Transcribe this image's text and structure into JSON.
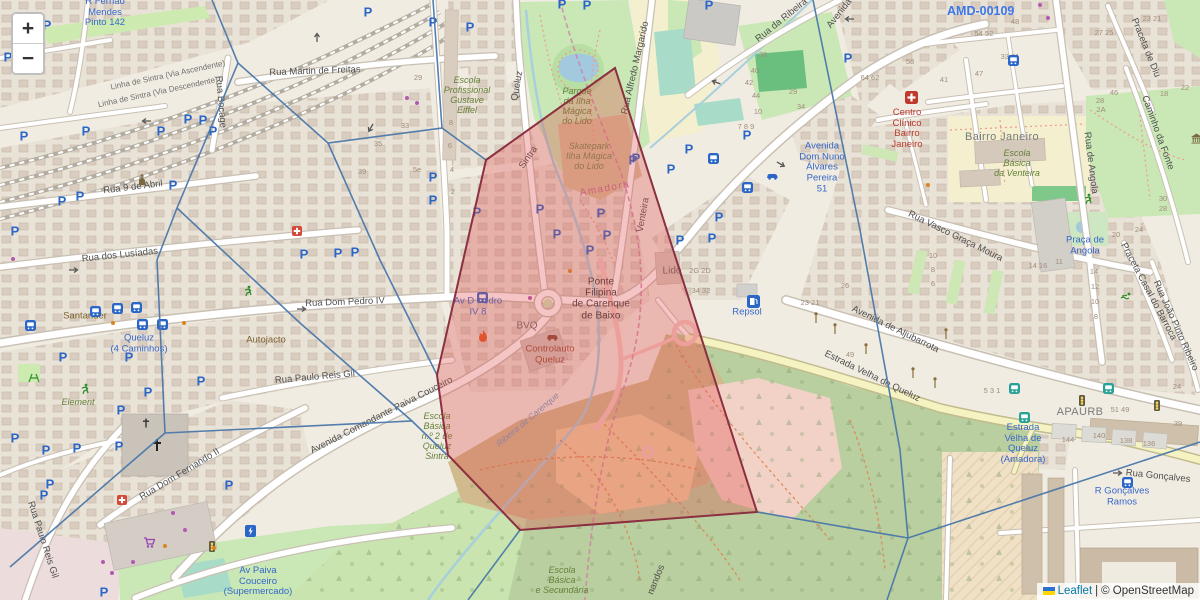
{
  "controls": {
    "zoom_in": "+",
    "zoom_out": "−"
  },
  "attribution": {
    "leaflet": "Leaflet",
    "sep": "|",
    "osm": "© OpenStreetMap"
  },
  "marker": {
    "ref": "AMD-00109"
  },
  "colors": {
    "overlay_fill": "#e04c4c",
    "overlay_stroke": "#8b3040",
    "voronoi_stroke": "#4a78aa",
    "parking_blue": "#2a66c8",
    "transit_blue": "#3667c9"
  },
  "labels": [
    {
      "t": "Rua Martin de Freitas",
      "x": 315,
      "y": 72,
      "c": "road",
      "r": -2
    },
    {
      "t": "Rua 9 de Abril",
      "x": 133,
      "y": 188,
      "c": "road",
      "r": -7
    },
    {
      "t": "Rua dos Lusíadas",
      "x": 120,
      "y": 256,
      "c": "road",
      "r": -6
    },
    {
      "t": "Rua Dom Pedro IV",
      "x": 345,
      "y": 303,
      "c": "road",
      "r": -2
    },
    {
      "t": "Rua Bocage",
      "x": 220,
      "y": 102,
      "c": "road",
      "r": 85
    },
    {
      "t": "Rua Paulo Reis Gil",
      "x": 315,
      "y": 378,
      "c": "road",
      "r": -5
    },
    {
      "t": "Rua Paulo Reis Gil",
      "x": 42,
      "y": 540,
      "c": "road",
      "r": 72
    },
    {
      "t": "Avenida Comandante Paiva Couceiro",
      "x": 382,
      "y": 416,
      "c": "road",
      "r": -27
    },
    {
      "t": "Rua Dom Fernando II",
      "x": 180,
      "y": 475,
      "c": "road",
      "r": -31
    },
    {
      "t": "Av Paiva\nCouceiro\n(Supermercado)",
      "x": 258,
      "y": 582,
      "c": "transit"
    },
    {
      "t": "Element",
      "x": 78,
      "y": 402,
      "c": "school"
    },
    {
      "t": "Santander",
      "x": 85,
      "y": 317,
      "c": "poi"
    },
    {
      "t": "Queluz\n(4 Caminhos)",
      "x": 139,
      "y": 344,
      "c": "transit"
    },
    {
      "t": "Autojacto",
      "x": 266,
      "y": 341,
      "c": "poi"
    },
    {
      "t": "Rua Alfredo Margarido",
      "x": 636,
      "y": 68,
      "c": "road",
      "r": -77
    },
    {
      "t": "Queluz",
      "x": 518,
      "y": 86,
      "c": "road",
      "r": -80
    },
    {
      "t": "Sintra",
      "x": 529,
      "y": 158,
      "c": "road",
      "r": -55
    },
    {
      "t": "Amadora",
      "x": 605,
      "y": 189,
      "c": "bound",
      "r": -10
    },
    {
      "t": "Venteira",
      "x": 644,
      "y": 215,
      "c": "road",
      "r": -80
    },
    {
      "t": "Lido",
      "x": 672,
      "y": 271,
      "c": "gray"
    },
    {
      "t": "Ponte\nFilipina\nde Carenque\nde Baixo",
      "x": 601,
      "y": 299,
      "c": "dark"
    },
    {
      "t": "Av D Pedro\nIV 8",
      "x": 478,
      "y": 307,
      "c": "transit"
    },
    {
      "t": "BVQ",
      "x": 527,
      "y": 326,
      "c": "gray"
    },
    {
      "t": "Controlauto\nQueluz",
      "x": 550,
      "y": 355,
      "c": "shopred"
    },
    {
      "t": "Repsol",
      "x": 747,
      "y": 313,
      "c": "transit"
    },
    {
      "t": "Avenida de Aljubarrota",
      "x": 895,
      "y": 330,
      "c": "road",
      "r": 26
    },
    {
      "t": "Estrada Velha de Queluz",
      "x": 872,
      "y": 377,
      "c": "road",
      "r": 26
    },
    {
      "t": "Rua Vasco Graça Moura",
      "x": 955,
      "y": 237,
      "c": "road",
      "r": 26
    },
    {
      "t": "Bairro Janeiro",
      "x": 1002,
      "y": 137,
      "c": "place"
    },
    {
      "t": "Escola\nBásica\nda Venteira",
      "x": 1017,
      "y": 163,
      "c": "school"
    },
    {
      "t": "Centro\nClínico\nBairro\nJaneiro",
      "x": 907,
      "y": 129,
      "c": "health"
    },
    {
      "t": "Avenida\nDom Nuno\nÁlvares\nPereira\n51",
      "x": 822,
      "y": 168,
      "c": "transit"
    },
    {
      "t": "Praceta de Diu",
      "x": 1145,
      "y": 48,
      "c": "road",
      "r": 68
    },
    {
      "t": "Caminho da Fonte",
      "x": 1157,
      "y": 133,
      "c": "road",
      "r": 70
    },
    {
      "t": "Rua de Angola",
      "x": 1090,
      "y": 163,
      "c": "road",
      "r": 83
    },
    {
      "t": "Praça de\nAngola",
      "x": 1085,
      "y": 246,
      "c": "transit"
    },
    {
      "t": "Praceta Casal do Barroca",
      "x": 1148,
      "y": 292,
      "c": "road",
      "r": 62
    },
    {
      "t": "Rua João Pinto Ribeiro",
      "x": 1175,
      "y": 326,
      "c": "road",
      "r": 66
    },
    {
      "t": "APAURB",
      "x": 1080,
      "y": 412,
      "c": "place"
    },
    {
      "t": "Estrada\nVelha de\nQueluz\n(Amadora)",
      "x": 1023,
      "y": 444,
      "c": "transit"
    },
    {
      "t": "Rua Gonçalves",
      "x": 1158,
      "y": 477,
      "c": "road",
      "r": 6
    },
    {
      "t": "R Gonçalves\nRamos",
      "x": 1122,
      "y": 497,
      "c": "transit"
    },
    {
      "t": "Escola\nBásica\ne Secundária",
      "x": 562,
      "y": 580,
      "c": "school"
    },
    {
      "t": "Escola\nBásica\nn.º 2 de\nQueluz\nSintra",
      "x": 437,
      "y": 436,
      "c": "school"
    },
    {
      "t": "Escola\nProfissional\nGustave\nEiffel",
      "x": 467,
      "y": 95,
      "c": "school"
    },
    {
      "t": "Parque\nda Ilha\nMágica\ndo Lido",
      "x": 577,
      "y": 106,
      "c": "school"
    },
    {
      "t": "Skatepark\nIlha Mágica\ndo Lido",
      "x": 589,
      "y": 156,
      "c": "leisure"
    },
    {
      "t": "R Fernão\nMendes\nPinto 142",
      "x": 105,
      "y": 13,
      "c": "transit"
    },
    {
      "t": "Linha de Sintra (Via Ascendente)",
      "x": 168,
      "y": 76,
      "c": "rail",
      "r": -12
    },
    {
      "t": "Linha de Sintra (Via Descendente)",
      "x": 158,
      "y": 93,
      "c": "rail",
      "r": -12
    },
    {
      "t": "Rua da Ribeira",
      "x": 782,
      "y": 21,
      "c": "road",
      "r": -39
    },
    {
      "t": "Avenida",
      "x": 840,
      "y": 14,
      "c": "road",
      "r": -52
    },
    {
      "t": "Ribeira de Carenque",
      "x": 528,
      "y": 420,
      "c": "water",
      "r": -40
    },
    {
      "t": "nandos",
      "x": 657,
      "y": 580,
      "c": "road",
      "r": -68
    },
    {
      "t": "29",
      "x": 418,
      "y": 78,
      "c": "num"
    },
    {
      "t": "33",
      "x": 405,
      "y": 126,
      "c": "num"
    },
    {
      "t": "8",
      "x": 451,
      "y": 123,
      "c": "num"
    },
    {
      "t": "6",
      "x": 450,
      "y": 146,
      "c": "num"
    },
    {
      "t": "4",
      "x": 452,
      "y": 170,
      "c": "num"
    },
    {
      "t": "2",
      "x": 453,
      "y": 192,
      "c": "num"
    },
    {
      "t": "5e",
      "x": 417,
      "y": 170,
      "c": "num"
    },
    {
      "t": "35",
      "x": 378,
      "y": 144,
      "c": "num"
    },
    {
      "t": "39",
      "x": 362,
      "y": 172,
      "c": "num"
    },
    {
      "t": "38",
      "x": 763,
      "y": 55,
      "c": "num"
    },
    {
      "t": "40",
      "x": 755,
      "y": 71,
      "c": "num"
    },
    {
      "t": "42",
      "x": 749,
      "y": 83,
      "c": "num"
    },
    {
      "t": "44",
      "x": 756,
      "y": 96,
      "c": "num"
    },
    {
      "t": "10",
      "x": 758,
      "y": 112,
      "c": "num"
    },
    {
      "t": "29",
      "x": 793,
      "y": 92,
      "c": "num"
    },
    {
      "t": "34",
      "x": 801,
      "y": 107,
      "c": "num"
    },
    {
      "t": "7 8 9",
      "x": 746,
      "y": 127,
      "c": "num"
    },
    {
      "t": "2G 2D",
      "x": 700,
      "y": 271,
      "c": "num"
    },
    {
      "t": "34 32",
      "x": 701,
      "y": 291,
      "c": "num"
    },
    {
      "t": "23 21",
      "x": 810,
      "y": 303,
      "c": "num"
    },
    {
      "t": "26",
      "x": 845,
      "y": 286,
      "c": "num"
    },
    {
      "t": "49",
      "x": 850,
      "y": 355,
      "c": "num"
    },
    {
      "t": "64 62",
      "x": 870,
      "y": 78,
      "c": "num"
    },
    {
      "t": "58",
      "x": 910,
      "y": 62,
      "c": "num"
    },
    {
      "t": "41",
      "x": 944,
      "y": 80,
      "c": "num"
    },
    {
      "t": "47",
      "x": 979,
      "y": 74,
      "c": "num"
    },
    {
      "t": "48",
      "x": 1015,
      "y": 22,
      "c": "num"
    },
    {
      "t": "54 52",
      "x": 984,
      "y": 34,
      "c": "num"
    },
    {
      "t": "33 31",
      "x": 1010,
      "y": 57,
      "c": "num"
    },
    {
      "t": "27 25",
      "x": 1104,
      "y": 33,
      "c": "num"
    },
    {
      "t": "46",
      "x": 1114,
      "y": 93,
      "c": "num"
    },
    {
      "t": "28",
      "x": 1100,
      "y": 101,
      "c": "num"
    },
    {
      "t": "2A",
      "x": 1101,
      "y": 110,
      "c": "num"
    },
    {
      "t": "23 21",
      "x": 1152,
      "y": 19,
      "c": "num"
    },
    {
      "t": "18",
      "x": 1164,
      "y": 94,
      "c": "num"
    },
    {
      "t": "22",
      "x": 1185,
      "y": 88,
      "c": "num"
    },
    {
      "t": "14 16",
      "x": 1038,
      "y": 266,
      "c": "num"
    },
    {
      "t": "11",
      "x": 1059,
      "y": 262,
      "c": "num"
    },
    {
      "t": "20",
      "x": 1116,
      "y": 235,
      "c": "num"
    },
    {
      "t": "24",
      "x": 1139,
      "y": 230,
      "c": "num"
    },
    {
      "t": "28",
      "x": 1163,
      "y": 209,
      "c": "num"
    },
    {
      "t": "30",
      "x": 1163,
      "y": 199,
      "c": "num"
    },
    {
      "t": "14",
      "x": 1094,
      "y": 272,
      "c": "num"
    },
    {
      "t": "12",
      "x": 1095,
      "y": 287,
      "c": "num"
    },
    {
      "t": "10",
      "x": 1095,
      "y": 302,
      "c": "num"
    },
    {
      "t": "8",
      "x": 1096,
      "y": 317,
      "c": "num"
    },
    {
      "t": "10",
      "x": 933,
      "y": 256,
      "c": "num"
    },
    {
      "t": "8",
      "x": 933,
      "y": 270,
      "c": "num"
    },
    {
      "t": "6",
      "x": 933,
      "y": 284,
      "c": "num"
    },
    {
      "t": "144",
      "x": 1068,
      "y": 440,
      "c": "num"
    },
    {
      "t": "140",
      "x": 1099,
      "y": 436,
      "c": "num"
    },
    {
      "t": "138",
      "x": 1126,
      "y": 441,
      "c": "num"
    },
    {
      "t": "136",
      "x": 1149,
      "y": 444,
      "c": "num"
    },
    {
      "t": "51 49",
      "x": 1120,
      "y": 410,
      "c": "num"
    },
    {
      "t": "39",
      "x": 1178,
      "y": 424,
      "c": "num"
    },
    {
      "t": "5 3 1",
      "x": 992,
      "y": 391,
      "c": "num"
    },
    {
      "t": "24",
      "x": 1177,
      "y": 387,
      "c": "num"
    }
  ],
  "icons": [
    {
      "k": "p",
      "x": 47,
      "y": 25
    },
    {
      "k": "p",
      "x": 8,
      "y": 57
    },
    {
      "k": "p",
      "x": 188,
      "y": 119
    },
    {
      "k": "p",
      "x": 203,
      "y": 120
    },
    {
      "k": "p",
      "x": 161,
      "y": 131
    },
    {
      "k": "p",
      "x": 86,
      "y": 131
    },
    {
      "k": "p",
      "x": 24,
      "y": 136
    },
    {
      "k": "p",
      "x": 62,
      "y": 201
    },
    {
      "k": "p",
      "x": 80,
      "y": 196
    },
    {
      "k": "p",
      "x": 173,
      "y": 185
    },
    {
      "k": "p",
      "x": 15,
      "y": 231
    },
    {
      "k": "p",
      "x": 63,
      "y": 357
    },
    {
      "k": "p",
      "x": 129,
      "y": 357
    },
    {
      "k": "p",
      "x": 148,
      "y": 392
    },
    {
      "k": "p",
      "x": 201,
      "y": 381
    },
    {
      "k": "p",
      "x": 121,
      "y": 410
    },
    {
      "k": "p",
      "x": 119,
      "y": 446
    },
    {
      "k": "p",
      "x": 46,
      "y": 450
    },
    {
      "k": "p",
      "x": 15,
      "y": 438
    },
    {
      "k": "p",
      "x": 77,
      "y": 448
    },
    {
      "k": "p",
      "x": 50,
      "y": 484
    },
    {
      "k": "p",
      "x": 44,
      "y": 495
    },
    {
      "k": "p",
      "x": 229,
      "y": 485
    },
    {
      "k": "p",
      "x": 104,
      "y": 592
    },
    {
      "k": "p",
      "x": 213,
      "y": 131
    },
    {
      "k": "p",
      "x": 368,
      "y": 12
    },
    {
      "k": "p",
      "x": 433,
      "y": 22
    },
    {
      "k": "p",
      "x": 433,
      "y": 177
    },
    {
      "k": "p",
      "x": 433,
      "y": 200
    },
    {
      "k": "p",
      "x": 304,
      "y": 254
    },
    {
      "k": "p",
      "x": 338,
      "y": 253
    },
    {
      "k": "p",
      "x": 355,
      "y": 252
    },
    {
      "k": "p",
      "x": 470,
      "y": 27
    },
    {
      "k": "p",
      "x": 562,
      "y": 4
    },
    {
      "k": "p",
      "x": 587,
      "y": 5
    },
    {
      "k": "p",
      "x": 477,
      "y": 212
    },
    {
      "k": "p",
      "x": 540,
      "y": 209
    },
    {
      "k": "p",
      "x": 601,
      "y": 213
    },
    {
      "k": "p",
      "x": 633,
      "y": 160
    },
    {
      "k": "p",
      "x": 557,
      "y": 234
    },
    {
      "k": "p",
      "x": 590,
      "y": 250
    },
    {
      "k": "p",
      "x": 607,
      "y": 235
    },
    {
      "k": "p",
      "x": 747,
      "y": 135
    },
    {
      "k": "p",
      "x": 689,
      "y": 149
    },
    {
      "k": "p",
      "x": 671,
      "y": 169
    },
    {
      "k": "p",
      "x": 719,
      "y": 217
    },
    {
      "k": "p",
      "x": 712,
      "y": 238
    },
    {
      "k": "p",
      "x": 680,
      "y": 240
    },
    {
      "k": "p",
      "x": 636,
      "y": 158
    },
    {
      "k": "p",
      "x": 848,
      "y": 58
    },
    {
      "k": "p",
      "x": 709,
      "y": 5
    },
    {
      "k": "bus",
      "x": 90,
      "y": 306
    },
    {
      "k": "bus",
      "x": 112,
      "y": 303
    },
    {
      "k": "bus",
      "x": 131,
      "y": 302
    },
    {
      "k": "bus",
      "x": 137,
      "y": 319
    },
    {
      "k": "bus",
      "x": 157,
      "y": 319
    },
    {
      "k": "bus",
      "x": 25,
      "y": 320
    },
    {
      "k": "bus",
      "x": 477,
      "y": 292
    },
    {
      "k": "bus",
      "x": 708,
      "y": 153
    },
    {
      "k": "bus",
      "x": 742,
      "y": 182
    },
    {
      "k": "bus",
      "x": 1122,
      "y": 477
    },
    {
      "k": "bus",
      "x": 1008,
      "y": 55
    },
    {
      "k": "tbus",
      "x": 1009,
      "y": 383
    },
    {
      "k": "tbus",
      "x": 1019,
      "y": 412
    },
    {
      "k": "tbus",
      "x": 1103,
      "y": 383
    },
    {
      "k": "light",
      "x": 208,
      "y": 541
    },
    {
      "k": "light",
      "x": 1078,
      "y": 395
    },
    {
      "k": "light",
      "x": 1153,
      "y": 400
    },
    {
      "k": "lamp",
      "x": 813,
      "y": 312
    },
    {
      "k": "lamp",
      "x": 832,
      "y": 323
    },
    {
      "k": "lamp",
      "x": 863,
      "y": 343
    },
    {
      "k": "lamp",
      "x": 910,
      "y": 367
    },
    {
      "k": "lamp",
      "x": 932,
      "y": 377
    },
    {
      "k": "lamp",
      "x": 943,
      "y": 328
    },
    {
      "k": "fuel",
      "x": 747,
      "y": 295
    },
    {
      "k": "hosp",
      "x": 905,
      "y": 91
    },
    {
      "k": "aid",
      "x": 292,
      "y": 226
    },
    {
      "k": "aid",
      "x": 117,
      "y": 495
    },
    {
      "k": "church",
      "x": 137,
      "y": 174
    },
    {
      "k": "cross",
      "x": 151,
      "y": 438
    },
    {
      "k": "crossS",
      "x": 142,
      "y": 418
    },
    {
      "k": "cart",
      "x": 143,
      "y": 537
    },
    {
      "k": "flame",
      "x": 478,
      "y": 330
    },
    {
      "k": "carR",
      "x": 546,
      "y": 333
    },
    {
      "k": "carB",
      "x": 766,
      "y": 172
    },
    {
      "k": "run",
      "x": 80,
      "y": 383
    },
    {
      "k": "run",
      "x": 243,
      "y": 285
    },
    {
      "k": "run",
      "x": 1083,
      "y": 193
    },
    {
      "k": "swim",
      "x": 1120,
      "y": 292
    },
    {
      "k": "play",
      "x": 28,
      "y": 373
    },
    {
      "k": "ev",
      "x": 245,
      "y": 525
    },
    {
      "k": "mon",
      "x": 1190,
      "y": 133
    },
    {
      "k": "dotP",
      "x": 103,
      "y": 562
    },
    {
      "k": "dotP",
      "x": 133,
      "y": 562
    },
    {
      "k": "dotP",
      "x": 112,
      "y": 573
    },
    {
      "k": "dotP",
      "x": 173,
      "y": 513
    },
    {
      "k": "dotP",
      "x": 185,
      "y": 530
    },
    {
      "k": "dotP",
      "x": 407,
      "y": 98
    },
    {
      "k": "dotP",
      "x": 417,
      "y": 103
    },
    {
      "k": "dotP",
      "x": 13,
      "y": 259
    },
    {
      "k": "dotP",
      "x": 530,
      "y": 298
    },
    {
      "k": "dotP",
      "x": 1040,
      "y": 5
    },
    {
      "k": "dotP",
      "x": 1048,
      "y": 18
    },
    {
      "k": "dotO",
      "x": 184,
      "y": 323
    },
    {
      "k": "dotO",
      "x": 113,
      "y": 323
    },
    {
      "k": "dotO",
      "x": 165,
      "y": 546
    },
    {
      "k": "dotO",
      "x": 570,
      "y": 271
    },
    {
      "k": "dotO",
      "x": 214,
      "y": 548
    },
    {
      "k": "dotO",
      "x": 928,
      "y": 185
    },
    {
      "k": "arr",
      "x": 313,
      "y": 43,
      "r": -90
    },
    {
      "k": "arr",
      "x": 855,
      "y": 23,
      "r": 180
    },
    {
      "k": "arr",
      "x": 1112,
      "y": 469,
      "r": 0
    },
    {
      "k": "arr",
      "x": 68,
      "y": 266,
      "r": 0
    },
    {
      "k": "arr",
      "x": 296,
      "y": 305,
      "r": 0
    },
    {
      "k": "arr",
      "x": 152,
      "y": 125,
      "r": 180
    },
    {
      "k": "arr",
      "x": 377,
      "y": 125,
      "r": 120
    },
    {
      "k": "arr",
      "x": 720,
      "y": 88,
      "r": 200
    },
    {
      "k": "arr",
      "x": 778,
      "y": 158,
      "r": 30
    }
  ],
  "overlays": {
    "red_polygon": "615,68 486,160 437,375 448,455 520,530 757,512",
    "voronoi_edges": [
      "212,0 238,63 328,143 442,128 433,0",
      "442,128 486,160",
      "328,143 380,260 437,375",
      "238,63 177,208 157,260 165,433",
      "177,208 300,323 412,421",
      "165,433 412,421 447,455",
      "165,433 10,567",
      "520,530 468,600",
      "757,512 908,538",
      "813,0 860,230 900,450 908,538",
      "908,538 887,600",
      "908,538 1200,442"
    ]
  }
}
